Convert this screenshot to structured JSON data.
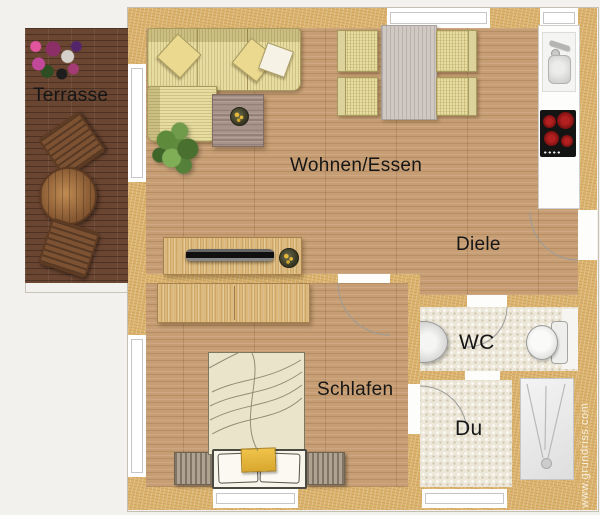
{
  "plan": {
    "labels": {
      "terrasse": "Terrasse",
      "wohnen_essen": "Wohnen/Essen",
      "diele": "Diele",
      "schlafen": "Schlafen",
      "wc": "WC",
      "du": "Du"
    },
    "watermark": "www.grundriss.com",
    "colors": {
      "background": "#f2f1ee",
      "wall": "#dcb46e",
      "floor": "#c79e74",
      "terrace_deck": "#6a4531",
      "tile": "#ece7d8",
      "furniture_beige": "#e7dda2",
      "wood_light": "#dcb97b",
      "dining_table_gray": "#cfc8c3",
      "cooktop_black": "#141414",
      "burner_red": "#7c1010",
      "accent_yellow": "#e5b73b",
      "label_text": "#161616"
    }
  }
}
